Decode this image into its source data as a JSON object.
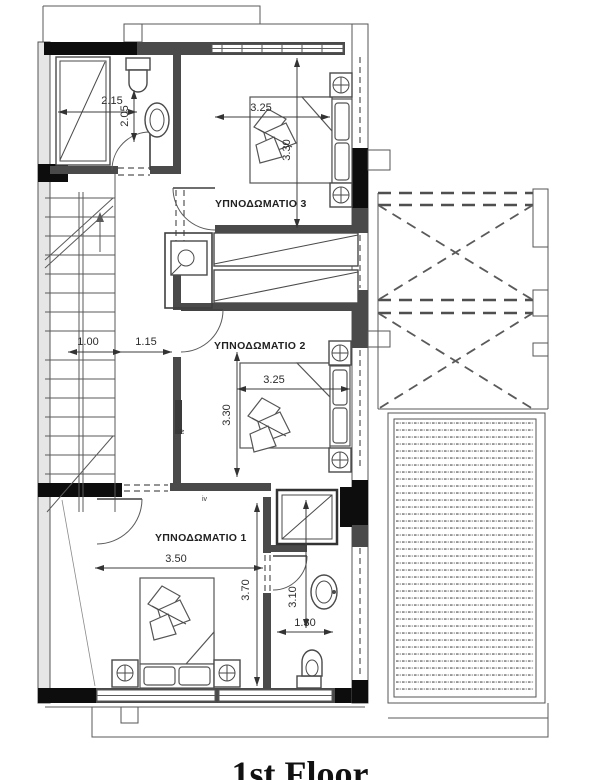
{
  "caption": "1st Floor",
  "labels": {
    "bedroom3": "ΥΠΝΟΔΩΜΑΤΙΟ 3",
    "bedroom2": "ΥΠΝΟΔΩΜΑΤΙΟ 2",
    "bedroom1": "ΥΠΝΟΔΩΜΑΤΙΟ 1"
  },
  "dims": {
    "bath_top_w": "2.15",
    "bath_top_h": "2.05",
    "stair_w": "1.00",
    "hall_w": "1.15",
    "br3_w": "3.25",
    "br3_h": "3.30",
    "br2_w": "3.25",
    "br2_h": "3.30",
    "br1_w": "3.50",
    "br1_h": "3.70",
    "bath_bottom_w": "1.30",
    "bath_bottom_h": "3.10"
  },
  "markers": {
    "window_type": "iv"
  },
  "colors": {
    "ink": "#3f3f3f",
    "wall": "#4a4a4a",
    "column": "#0d0d0d",
    "paper": "#ffffff",
    "dots": "#8a8a8a"
  }
}
